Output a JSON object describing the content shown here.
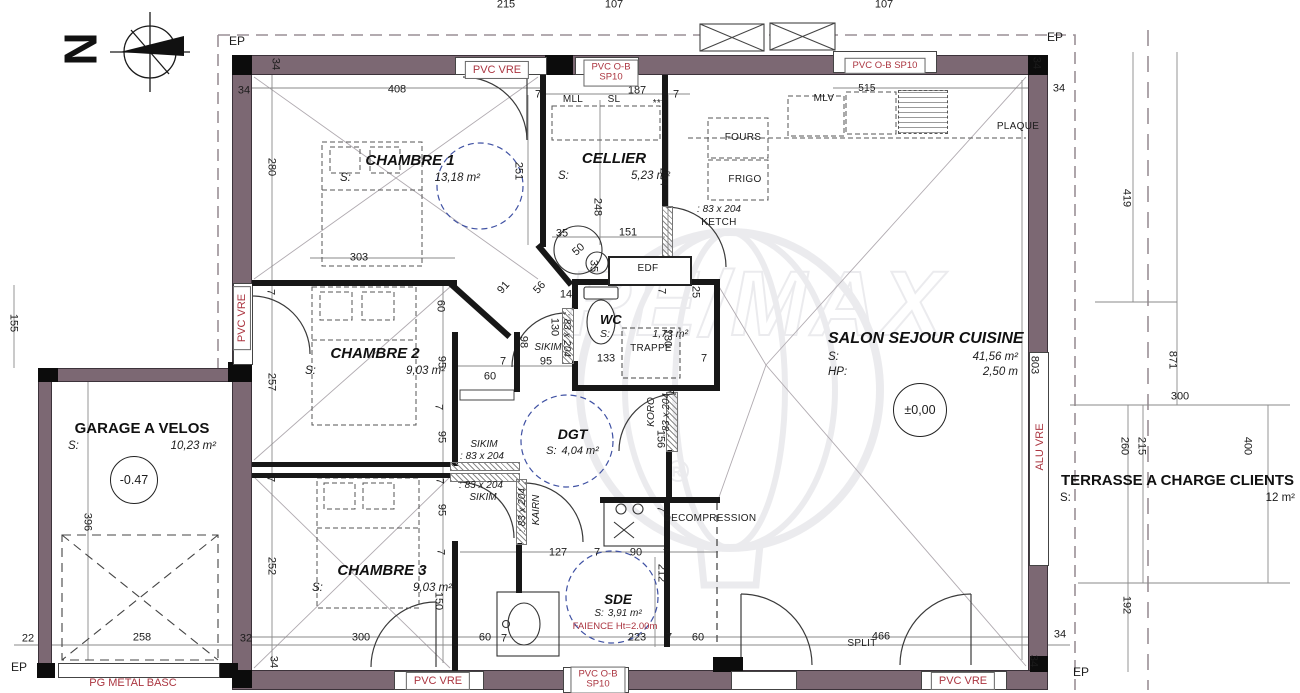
{
  "colors": {
    "wall": "#7c6873",
    "red_label": "#ab3540",
    "dashed_circle": "#3f51a3",
    "ink": "#1c1c1c"
  },
  "compass": {
    "letter": "N"
  },
  "watermark": {
    "text": "RE/MAX",
    "reg": "R"
  },
  "rooms": [
    {
      "name": "CHAMBRE 1",
      "s_label": "S:",
      "area": "13,18 m²"
    },
    {
      "name": "CELLIER",
      "s_label": "S:",
      "area": "5,23 m²"
    },
    {
      "name": "WC",
      "s_label": "S:",
      "area": "1,73 m²"
    },
    {
      "name": "CHAMBRE 2",
      "s_label": "S:",
      "area": "9,03 m²"
    },
    {
      "name": "CHAMBRE 3",
      "s_label": "S:",
      "area": "9,03 m²"
    },
    {
      "name": "DGT",
      "s_label": "S:",
      "area": "4,04 m²"
    },
    {
      "name": "SDE",
      "s_label": "S:",
      "area": "3,91 m²",
      "note": "FAIENCE Ht=2.00m"
    },
    {
      "name": "SALON SEJOUR CUISINE",
      "s_label": "S:",
      "area": "41,56 m²",
      "hp_label": "HP:",
      "hp_value": "2,50 m",
      "level": "±0,00"
    },
    {
      "name": "GARAGE A VELOS",
      "s_label": "S:",
      "area": "10,23 m²",
      "level": "-0.47"
    },
    {
      "name": "TERRASSE A CHARGE CLIENTS",
      "s_label": "S:",
      "area": "12 m²"
    }
  ],
  "ep_labels": [
    [
      "EP",
      237,
      41
    ],
    [
      "EP",
      1055,
      37
    ],
    [
      "EP",
      19,
      667
    ],
    [
      "EP",
      1081,
      672
    ]
  ],
  "red_labels": [
    {
      "text": "PVC VRE",
      "x": 497,
      "y": 70,
      "boxed": true
    },
    {
      "lines": [
        "PVC O-B",
        "SP10"
      ],
      "x": 611,
      "y": 73,
      "boxed": true,
      "small": true
    },
    {
      "text": "PVC O-B SP10",
      "x": 885,
      "y": 66,
      "boxed": true,
      "small": true
    },
    {
      "text": "PVC VRE",
      "x": 242,
      "y": 318,
      "rot": -90,
      "boxed": true
    },
    {
      "text": "ALU VRE",
      "x": 1040,
      "y": 447,
      "rot": -90,
      "boxed": false
    },
    {
      "text": "PVC VRE",
      "x": 438,
      "y": 681,
      "boxed": true
    },
    {
      "lines": [
        "PVC O-B",
        "SP10"
      ],
      "x": 598,
      "y": 680,
      "boxed": true,
      "small": true
    },
    {
      "text": "PVC VRE",
      "x": 963,
      "y": 681,
      "boxed": true
    },
    {
      "text": "PG METAL BASC",
      "x": 133,
      "y": 683,
      "boxed": false
    },
    {
      "text": "FAIENCE Ht=2.00m",
      "x": 615,
      "y": 627,
      "boxed": false,
      "small": true
    }
  ],
  "equipment": [
    [
      "MLL",
      573,
      100
    ],
    [
      "SL",
      614,
      100
    ],
    [
      "***",
      659,
      104
    ],
    [
      "MLV",
      824,
      99
    ],
    [
      "515",
      867,
      89
    ],
    [
      "FOURS",
      743,
      138
    ],
    [
      "FRIGO",
      745,
      180
    ],
    [
      "KETCH",
      719,
      223
    ],
    [
      "PLAQUE",
      1018,
      127
    ],
    [
      "EDF",
      648,
      269
    ],
    [
      "TRAPPE",
      651,
      349
    ],
    [
      "DECOMPRESSION",
      710,
      519
    ],
    [
      "SPLIT",
      862,
      644
    ]
  ],
  "door_tags": [
    [
      ": 83 x 204",
      719,
      210
    ],
    [
      "SIKIM",
      548,
      348
    ],
    [
      ": 83 x 204",
      566,
      335,
      90
    ],
    [
      "SIKIM",
      484,
      445
    ],
    [
      ": 83 x 204",
      482,
      457
    ],
    [
      ": 83 x 204",
      481,
      486
    ],
    [
      "SIKIM",
      483,
      498
    ],
    [
      "KAIRN",
      537,
      510,
      -90
    ],
    [
      ": 83 x 204",
      523,
      510,
      -90
    ],
    [
      "KORO",
      652,
      412,
      -90
    ],
    [
      ": 83 x 204",
      667,
      415,
      -90
    ]
  ],
  "dimensions": [
    [
      "215",
      506,
      5
    ],
    [
      "107",
      614,
      5
    ],
    [
      "107",
      884,
      5
    ],
    [
      "34",
      244,
      91
    ],
    [
      "34",
      275,
      64,
      90
    ],
    [
      "408",
      397,
      90
    ],
    [
      "7",
      538,
      95
    ],
    [
      "187",
      637,
      91
    ],
    [
      "7",
      676,
      95
    ],
    [
      "34",
      1036,
      63,
      90
    ],
    [
      "34",
      1059,
      89
    ],
    [
      "280",
      271,
      167,
      90
    ],
    [
      "251",
      518,
      171,
      90
    ],
    [
      "248",
      597,
      207,
      90
    ],
    [
      "284",
      663,
      177,
      90
    ],
    [
      "303",
      359,
      258
    ],
    [
      "151",
      628,
      233
    ],
    [
      "35",
      562,
      234
    ],
    [
      "50",
      579,
      250,
      -42
    ],
    [
      "35",
      593,
      266,
      90
    ],
    [
      "91",
      504,
      288,
      -48
    ],
    [
      "56",
      540,
      288,
      -48
    ],
    [
      "14",
      566,
      295
    ],
    [
      "98",
      523,
      342,
      90
    ],
    [
      "95",
      546,
      362
    ],
    [
      "7",
      503,
      362
    ],
    [
      "60",
      490,
      377
    ],
    [
      "130",
      554,
      327,
      90
    ],
    [
      "133",
      606,
      359
    ],
    [
      "7",
      704,
      359
    ],
    [
      "130",
      667,
      338,
      90
    ],
    [
      "25",
      695,
      292,
      90
    ],
    [
      "7",
      661,
      291,
      90
    ],
    [
      "156",
      660,
      439,
      90
    ],
    [
      "7",
      669,
      391,
      90
    ],
    [
      "257",
      271,
      382,
      90
    ],
    [
      "7",
      270,
      292,
      90
    ],
    [
      "60",
      440,
      306,
      90
    ],
    [
      "95",
      441,
      362,
      90
    ],
    [
      "7",
      438,
      407,
      90
    ],
    [
      "95",
      441,
      437,
      90
    ],
    [
      "252",
      271,
      566,
      90
    ],
    [
      "7",
      270,
      479,
      90
    ],
    [
      "7",
      439,
      481,
      90
    ],
    [
      "95",
      441,
      510,
      90
    ],
    [
      "7",
      440,
      552,
      90
    ],
    [
      "150",
      438,
      601,
      90
    ],
    [
      "300",
      361,
      638
    ],
    [
      "60",
      485,
      638
    ],
    [
      "7",
      504,
      639
    ],
    [
      "34",
      273,
      662,
      90
    ],
    [
      "32",
      246,
      639
    ],
    [
      "258",
      142,
      638
    ],
    [
      "22",
      28,
      639
    ],
    [
      "155",
      13,
      323,
      90
    ],
    [
      "396",
      87,
      522,
      90
    ],
    [
      "127",
      558,
      553
    ],
    [
      "7",
      597,
      553
    ],
    [
      "90",
      636,
      553
    ],
    [
      "7",
      666,
      554
    ],
    [
      "212",
      661,
      573,
      90
    ],
    [
      "7",
      660,
      509,
      90
    ],
    [
      "223",
      637,
      638
    ],
    [
      "7",
      669,
      638
    ],
    [
      "60",
      698,
      638
    ],
    [
      "466",
      881,
      637
    ],
    [
      "34",
      1033,
      661,
      90
    ],
    [
      "34",
      1060,
      635
    ],
    [
      "803",
      1034,
      365,
      90
    ],
    [
      "419",
      1126,
      198,
      90
    ],
    [
      "871",
      1172,
      360,
      90
    ],
    [
      "300",
      1180,
      397
    ],
    [
      "260",
      1124,
      446,
      90
    ],
    [
      "215",
      1141,
      446,
      90
    ],
    [
      "400",
      1247,
      446,
      90
    ],
    [
      "192",
      1126,
      605,
      90
    ]
  ]
}
